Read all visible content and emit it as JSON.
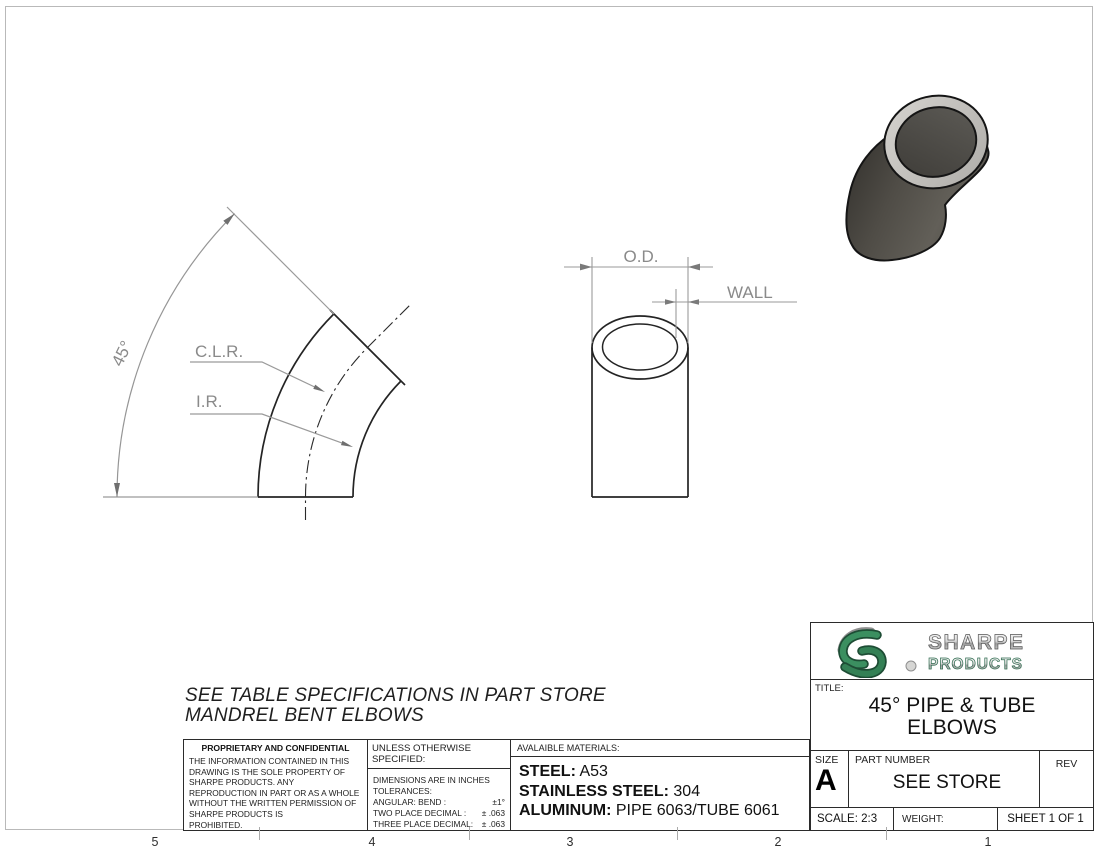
{
  "sheet": {
    "zones_bottom": [
      "5",
      "4",
      "3",
      "2",
      "1"
    ]
  },
  "drawing": {
    "angle_label": "45°",
    "clr_label": "C.L.R.",
    "ir_label": "I.R.",
    "od_label": "O.D.",
    "wall_label": "WALL",
    "note_line1": "SEE TABLE SPECIFICATIONS IN PART STORE",
    "note_line2": "MANDREL BENT ELBOWS"
  },
  "proprietary": {
    "title": "PROPRIETARY AND CONFIDENTIAL",
    "lines": [
      "THE INFORMATION CONTAINED IN THIS",
      "DRAWING IS THE SOLE PROPERTY OF",
      "SHARPE PRODUCTS.  ANY",
      "REPRODUCTION IN PART OR AS A WHOLE",
      "WITHOUT THE WRITTEN PERMISSION OF",
      "SHARPE PRODUCTS IS",
      "PROHIBITED."
    ]
  },
  "tolerances": {
    "header": "UNLESS OTHERWISE SPECIFIED:",
    "intro1": "DIMENSIONS ARE IN INCHES",
    "intro2": "TOLERANCES:",
    "rows": [
      {
        "label": "ANGULAR: BEND :",
        "value": "±1°"
      },
      {
        "label": "TWO PLACE DECIMAL :",
        "value": "± .063"
      },
      {
        "label": "THREE PLACE DECIMAL:",
        "value": "± .063"
      }
    ]
  },
  "materials": {
    "header": "AVALAIBLE MATERIALS:",
    "rows": [
      {
        "label": "STEEL:",
        "value": "A53"
      },
      {
        "label": "STAINLESS STEEL:",
        "value": "304"
      },
      {
        "label": "ALUMINUM:",
        "value": "PIPE 6063/TUBE 6061"
      }
    ]
  },
  "title_block": {
    "brand_line1": "SHARPE",
    "brand_line2": "PRODUCTS",
    "title_label": "TITLE:",
    "title_line1": "45° PIPE & TUBE",
    "title_line2": "ELBOWS",
    "size_label": "SIZE",
    "size_value": "A",
    "part_label": "PART NUMBER",
    "part_value": "SEE STORE",
    "rev_label": "REV",
    "scale_label": "SCALE: 2:3",
    "weight_label": "WEIGHT:",
    "sheet_label": "SHEET 1 OF 1"
  },
  "colors": {
    "part_line": "#242424",
    "dim_line": "#9a9a9a",
    "dim_text": "#8a8a8a",
    "elbow_body": "#55524c",
    "elbow_rim": "#c6c4c0",
    "logo_green": "#2f7a52"
  }
}
